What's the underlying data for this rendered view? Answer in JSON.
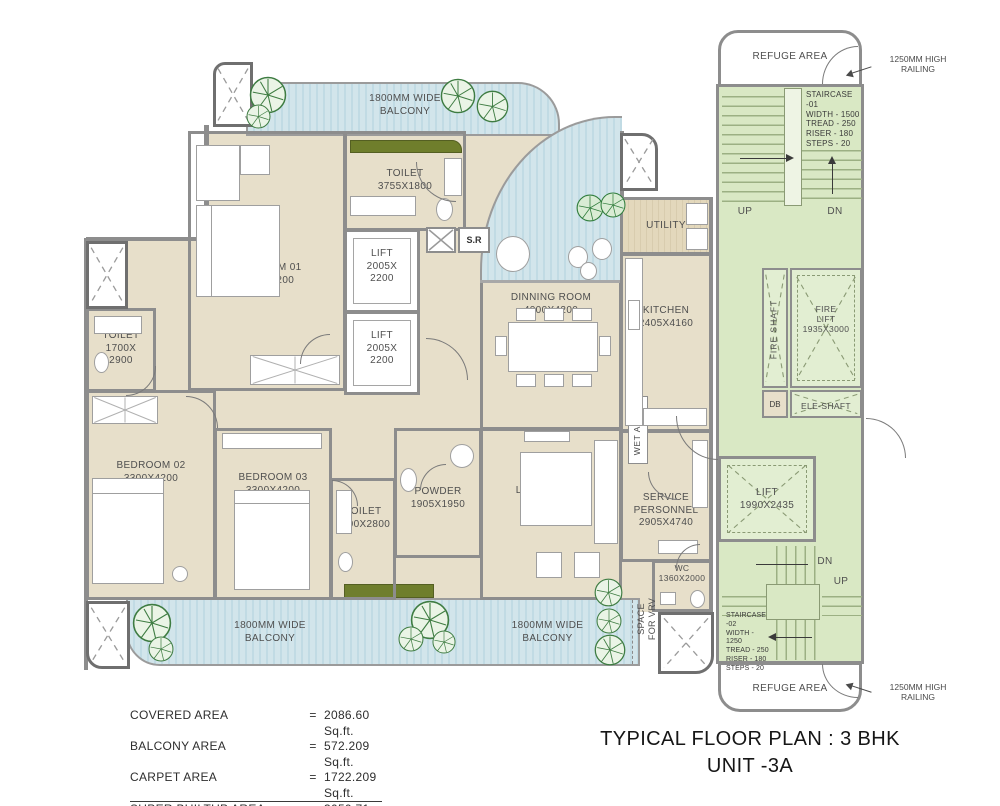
{
  "colors": {
    "floor_beige": "#e7dfca",
    "balcony_blue": "#cfe3ea",
    "core_green": "#d9e8c4",
    "wall_gray": "#8d8d8d",
    "planter_olive": "#6f7e2c",
    "tree_green": "#3e7c42"
  },
  "title": {
    "line1": "TYPICAL FLOOR PLAN : 3 BHK",
    "line2": "UNIT -3A"
  },
  "area_table": {
    "rows": [
      {
        "label": "COVERED AREA",
        "eq": "=",
        "value": "2086.60 Sq.ft."
      },
      {
        "label": "BALCONY AREA",
        "eq": "=",
        "value": "572.209 Sq.ft."
      },
      {
        "label": "CARPET AREA",
        "eq": "=",
        "value": "1722.209 Sq.ft."
      },
      {
        "label": "SUPER BUILTUP AREA",
        "eq": "=",
        "value": "3050.71 Sq.ft."
      }
    ]
  },
  "balconies": {
    "top": {
      "line1": "1800MM WIDE",
      "line2": "BALCONY"
    },
    "bottom_left": {
      "line1": "1800MM WIDE",
      "line2": "BALCONY"
    },
    "bottom_center": {
      "line1": "1800MM WIDE",
      "line2": "BALCONY"
    }
  },
  "rooms": {
    "bedroom1": {
      "name": "BEDROOM 01",
      "size": "3300X6200"
    },
    "bedroom2": {
      "name": "BEDROOM 02",
      "size": "3300X4200"
    },
    "bedroom3": {
      "name": "BEDROOM 03",
      "size": "3300X4200"
    },
    "toilet_b1": {
      "name": "TOILET",
      "size": "3755X1800"
    },
    "toilet_left": {
      "name": "TOILET",
      "size1": "1700X",
      "size2": "2900"
    },
    "toilet_b3": {
      "name": "TOILET",
      "size": "1700X2800"
    },
    "powder": {
      "name": "POWDER",
      "size": "1905X1950"
    },
    "living": {
      "name": "LIVING ROOM",
      "size": "3500X3180"
    },
    "dining": {
      "name": "DINNING ROOM",
      "size": "4000X4200"
    },
    "kitchen": {
      "name": "KITCHEN",
      "size": "2405X4160"
    },
    "utility": {
      "name": "UTILITY"
    },
    "wet_area": {
      "name": "WET AREA"
    },
    "service": {
      "name1": "SERVICE",
      "name2": "PERSONNEL",
      "size": "2905X4740"
    },
    "wc": {
      "name": "WC",
      "size": "1360X2000"
    },
    "vrv": {
      "line1": "SPACE",
      "line2": "FOR VRV"
    },
    "sr": {
      "name": "S.R"
    },
    "lift_a": {
      "name": "LIFT",
      "size1": "2005X",
      "size2": "2200"
    },
    "lift_b": {
      "name": "LIFT",
      "size1": "2005X",
      "size2": "2200"
    }
  },
  "core": {
    "refuge_top": "REFUGE AREA",
    "refuge_bottom": "REFUGE AREA",
    "railing_top": {
      "line1": "1250MM HIGH",
      "line2": "RAILING"
    },
    "railing_bottom": {
      "line1": "1250MM HIGH",
      "line2": "RAILING"
    },
    "staircase1": {
      "lines": [
        "STAIRCASE -01",
        "WIDTH - 1500",
        "TREAD - 250",
        "RISER - 180",
        "STEPS - 20"
      ],
      "up": "UP",
      "dn": "DN"
    },
    "staircase2": {
      "lines": [
        "STAIRCASE -02",
        "WIDTH - 1250",
        "TREAD - 250",
        "RISER - 180",
        "STEPS - 20"
      ],
      "up": "UP",
      "dn": "DN"
    },
    "fire_shaft": "FIRE SHAFT",
    "fire_lift": {
      "name1": "FIRE",
      "name2": "LIFT",
      "size": "1935X3000"
    },
    "db": "DB",
    "ele_shaft": "ELE-SHAFT",
    "lift": {
      "name": "LIFT",
      "size": "1990X2435"
    }
  }
}
